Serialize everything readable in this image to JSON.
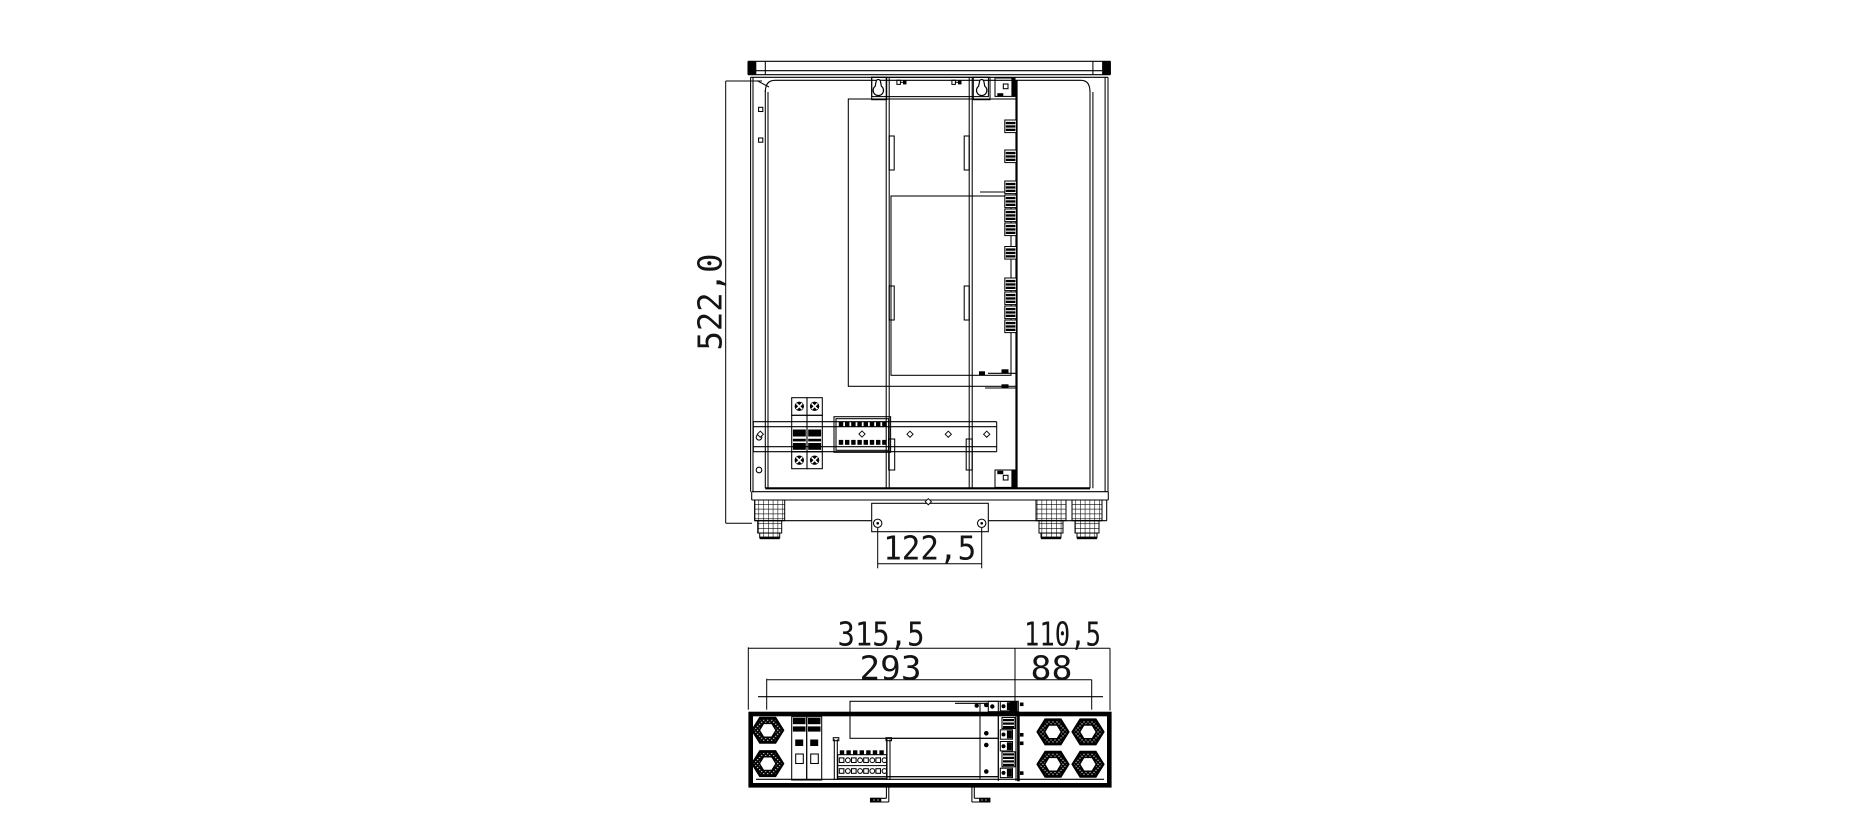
{
  "drawing": {
    "kind": "cad-technical-drawing",
    "colors": {
      "line": "#000000",
      "background": "#ffffff"
    }
  },
  "views": {
    "top_view": {
      "dims": {
        "height": "522,0",
        "slot_spacing": "122,5"
      }
    },
    "front_view": {
      "dims": {
        "overall_width": "315,5",
        "gland_section": "110,5",
        "inner_width": "293",
        "gland_inner": "88"
      }
    }
  }
}
